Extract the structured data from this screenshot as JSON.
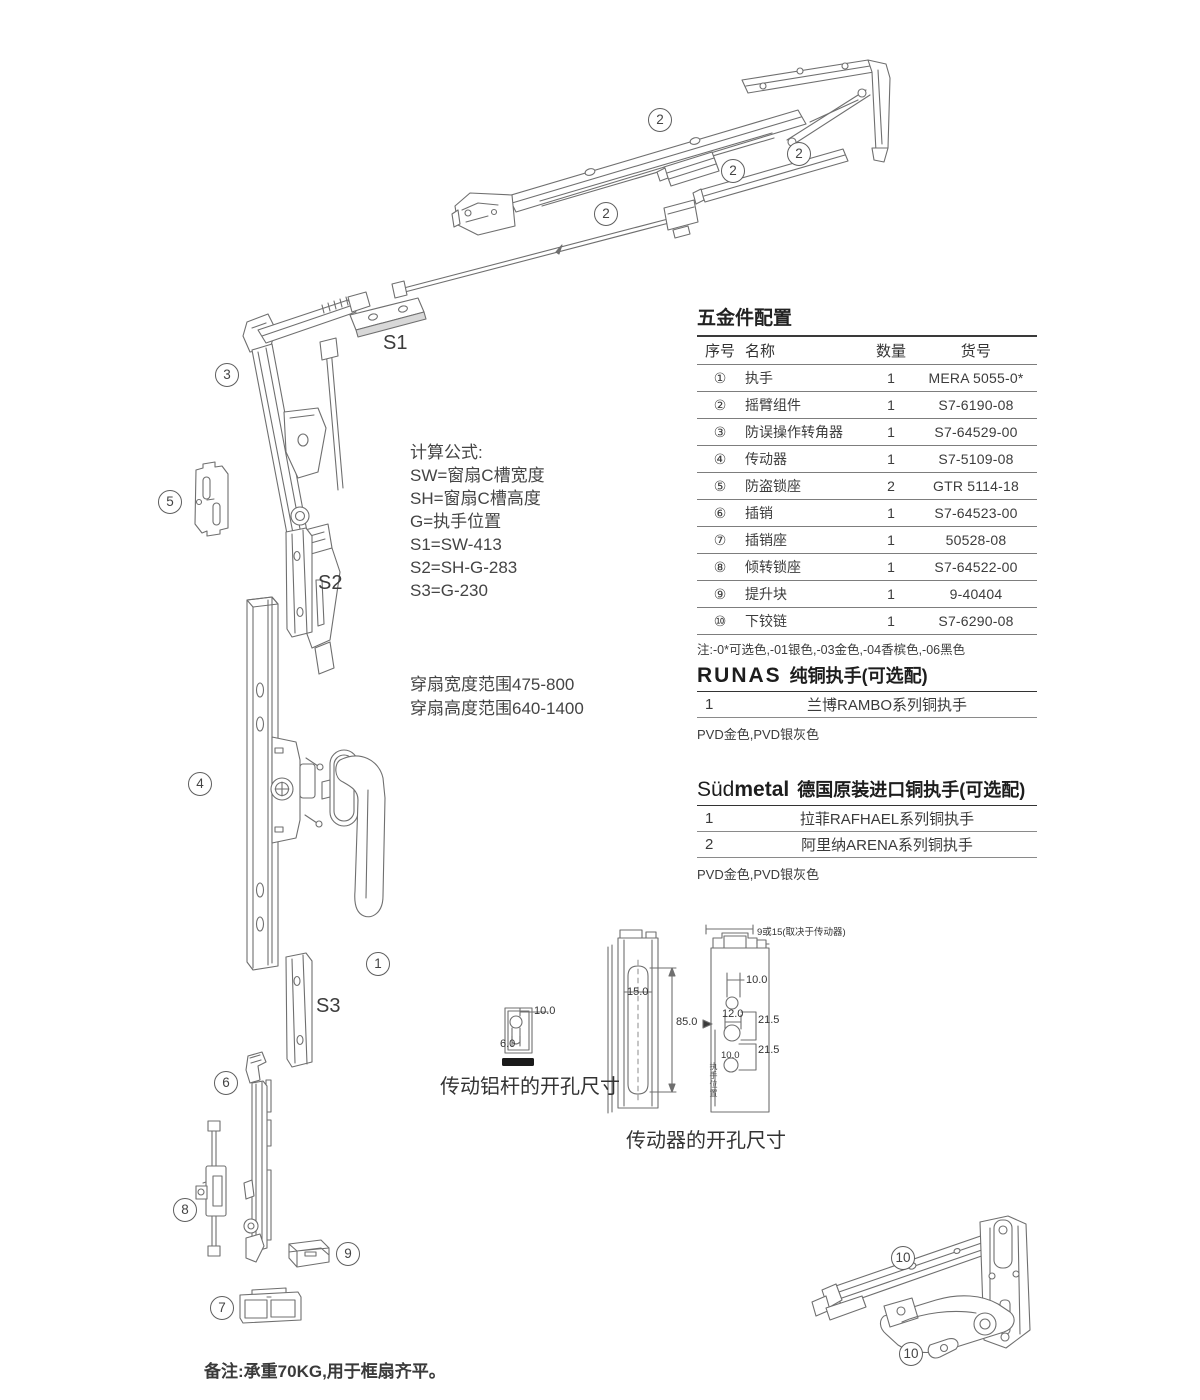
{
  "colors": {
    "line": "#6f6f6f",
    "text": "#3a3a3a",
    "bar": "#1a1a1a"
  },
  "hardware_table": {
    "title": "五金件配置",
    "headers": [
      "序号",
      "名称",
      "数量",
      "货号"
    ],
    "rows": [
      {
        "no": "①",
        "name": "执手",
        "qty": "1",
        "code": "MERA 5055-0*"
      },
      {
        "no": "②",
        "name": "摇臂组件",
        "qty": "1",
        "code": "S7-6190-08"
      },
      {
        "no": "③",
        "name": "防误操作转角器",
        "qty": "1",
        "code": "S7-64529-00"
      },
      {
        "no": "④",
        "name": "传动器",
        "qty": "1",
        "code": "S7-5109-08"
      },
      {
        "no": "⑤",
        "name": "防盗锁座",
        "qty": "2",
        "code": "GTR 5114-18"
      },
      {
        "no": "⑥",
        "name": "插销",
        "qty": "1",
        "code": "S7-64523-00"
      },
      {
        "no": "⑦",
        "name": "插销座",
        "qty": "1",
        "code": "50528-08"
      },
      {
        "no": "⑧",
        "name": "倾转锁座",
        "qty": "1",
        "code": "S7-64522-00"
      },
      {
        "no": "⑨",
        "name": "提升块",
        "qty": "1",
        "code": "9-40404"
      },
      {
        "no": "⑩",
        "name": "下铰链",
        "qty": "1",
        "code": "S7-6290-08"
      }
    ],
    "note": "注:-0*可选色,-01银色,-03金色,-04香槟色,-06黑色"
  },
  "runas": {
    "brand": "RUNAS",
    "title": "纯铜执手(可选配)",
    "rows": [
      {
        "no": "1",
        "name": "兰博RAMBO系列铜执手"
      }
    ],
    "note": "PVD金色,PVD银灰色"
  },
  "sudmetal": {
    "brand_light": "Süd",
    "brand_bold": "metal",
    "title": "德国原装进口铜执手(可选配)",
    "rows": [
      {
        "no": "1",
        "name": "拉菲RAFHAEL系列铜执手"
      },
      {
        "no": "2",
        "name": "阿里纳ARENA系列铜执手"
      }
    ],
    "note": "PVD金色,PVD银灰色"
  },
  "formulas": {
    "heading": "计算公式:",
    "lines": [
      "SW=窗扇C槽宽度",
      "SH=窗扇C槽高度",
      "G=执手位置",
      "S1=SW-413",
      "S2=SH-G-283",
      "S3=G-230"
    ]
  },
  "ranges": {
    "lines": [
      "穿扇宽度范围475-800",
      "穿扇高度范围640-1400"
    ]
  },
  "callouts": {
    "n1": "1",
    "n2": "2",
    "n3": "3",
    "n4": "4",
    "n5": "5",
    "n6": "6",
    "n7": "7",
    "n8": "8",
    "n9": "9",
    "n10": "10",
    "s1": "S1",
    "s2": "S2",
    "s3": "S3"
  },
  "dim_small": {
    "caption": "传动铝杆的开孔尺寸",
    "d_width": "10.0",
    "d_slot": "6.0"
  },
  "dim_mid": {
    "caption": "传动器的开孔尺寸",
    "d_slot_width": "15.0",
    "d_slot_height": "85.0"
  },
  "dim_right": {
    "top_note": "9或15(取决于传动器)",
    "d_top": "10.0",
    "d_mid": "12.0",
    "d_step1": "21.5",
    "d_step2": "21.5",
    "d_low": "10.0",
    "side_label": "执手位置"
  },
  "footer_note": "备注:承重70KG,用于框扇齐平。"
}
